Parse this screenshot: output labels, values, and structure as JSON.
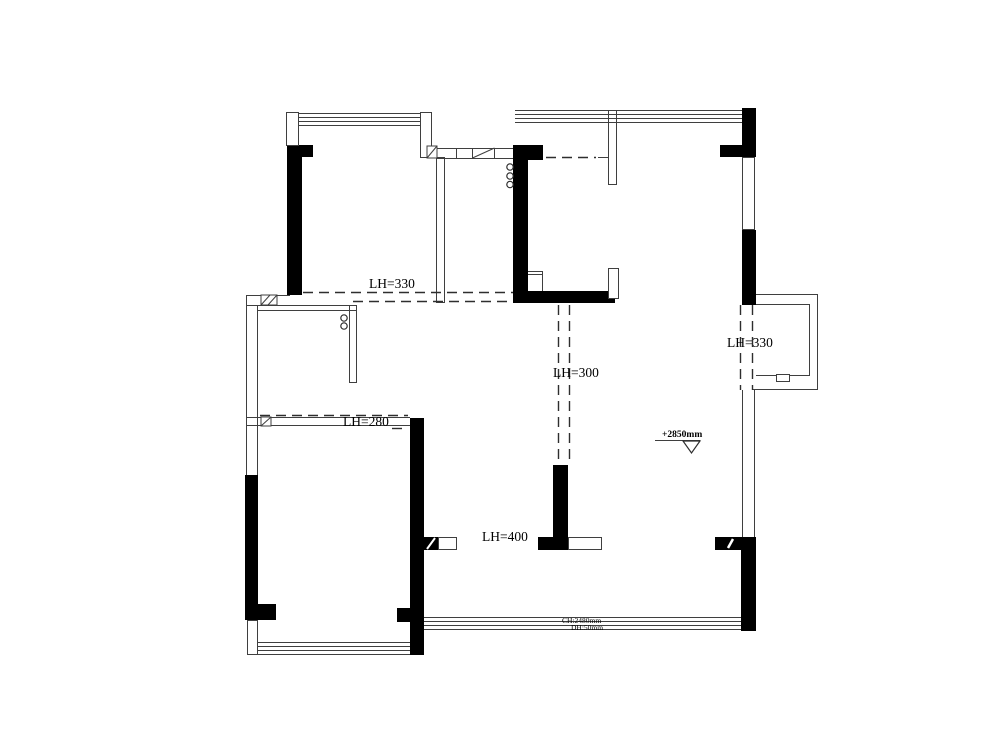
{
  "drawing": {
    "type": "floor-plan",
    "colors": {
      "wall": "#000000",
      "thin_line": "#3f3f3f",
      "dash_line": "#2e2e2e",
      "background": "#ffffff"
    },
    "labels": {
      "beam_top_left": "LH=330",
      "beam_center": "LH=300",
      "beam_right": "LH=330",
      "beam_mid_left": "LH=280",
      "beam_bottom_center": "LH=400",
      "level_mark": "+2850mm",
      "window_note_line1": "CH:2480mm",
      "window_note_line2": "DH:50mm"
    },
    "symbols": {
      "level_marker": "triangle-down-outline",
      "pipe_markers": "small-circles",
      "window_marks": "hatched-rectangles"
    }
  }
}
